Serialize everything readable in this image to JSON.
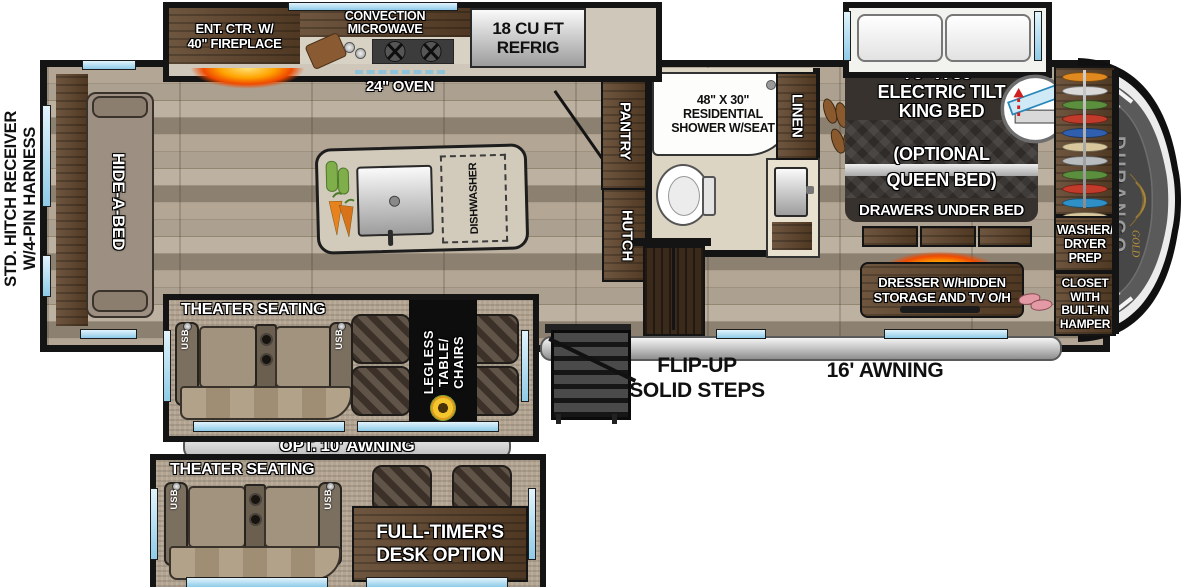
{
  "hitch": {
    "line1": "STD. HITCH RECEIVER",
    "line2": "W/4-PIN HARNESS"
  },
  "kitchen": {
    "ent_ctr": [
      "ENT. CTR. W/",
      "40\" FIREPLACE"
    ],
    "microwave": [
      "CONVECTION",
      "MICROWAVE"
    ],
    "refrig": [
      "18 CU FT",
      "REFRIG"
    ],
    "oven": "24\" OVEN",
    "dishwasher": "DISHWASHER"
  },
  "living": {
    "hide_a_bed": "HIDE-A-BED",
    "theater": "THEATER SEATING",
    "usb": "USB",
    "legless": [
      "LEGLESS",
      "TABLE/",
      "CHAIRS"
    ],
    "opt_awning": "OPT. 10' AWNING"
  },
  "hall": {
    "pantry": "PANTRY",
    "hutch": "HUTCH"
  },
  "bath": {
    "shower": [
      "48\" X 30\"",
      "RESIDENTIAL",
      "SHOWER W/SEAT"
    ],
    "linen": "LINEN"
  },
  "bedroom": {
    "bed": [
      "70\" X 80\"",
      "ELECTRIC TILT",
      "KING BED"
    ],
    "optional": [
      "(OPTIONAL",
      "QUEEN BED)"
    ],
    "drawers": "DRAWERS UNDER BED",
    "dresser": [
      "DRESSER W/HIDDEN",
      "STORAGE AND TV O/H"
    ],
    "washer": [
      "WASHER/",
      "DRYER",
      "PREP"
    ],
    "closet": [
      "CLOSET",
      "WITH",
      "BUILT-IN",
      "HAMPER"
    ]
  },
  "exterior": {
    "steps": [
      "FLIP-UP",
      "SOLID STEPS"
    ],
    "awning": "16' AWNING",
    "brand": "DURANGO",
    "brand_sub": "GOLD"
  },
  "option_box": {
    "theater": "THEATER SEATING",
    "usb": "USB",
    "desk": [
      "FULL-TIMER'S",
      "DESK OPTION"
    ]
  },
  "colors": {
    "window_blue": "#a9d9f0",
    "cabinet_brown": "#5d4229",
    "fire_accent": "#ff7a00",
    "awning_silver": "#d8d8d8",
    "hangers": [
      "#e0891e",
      "#d9d9d9",
      "#5b8f3e",
      "#c23b2a",
      "#2f5fae",
      "#d8c79c",
      "#b9bdc0",
      "#5b8f3e",
      "#c23b2a",
      "#2f8fc7",
      "#d8c79c",
      "#5b8f3e"
    ]
  }
}
